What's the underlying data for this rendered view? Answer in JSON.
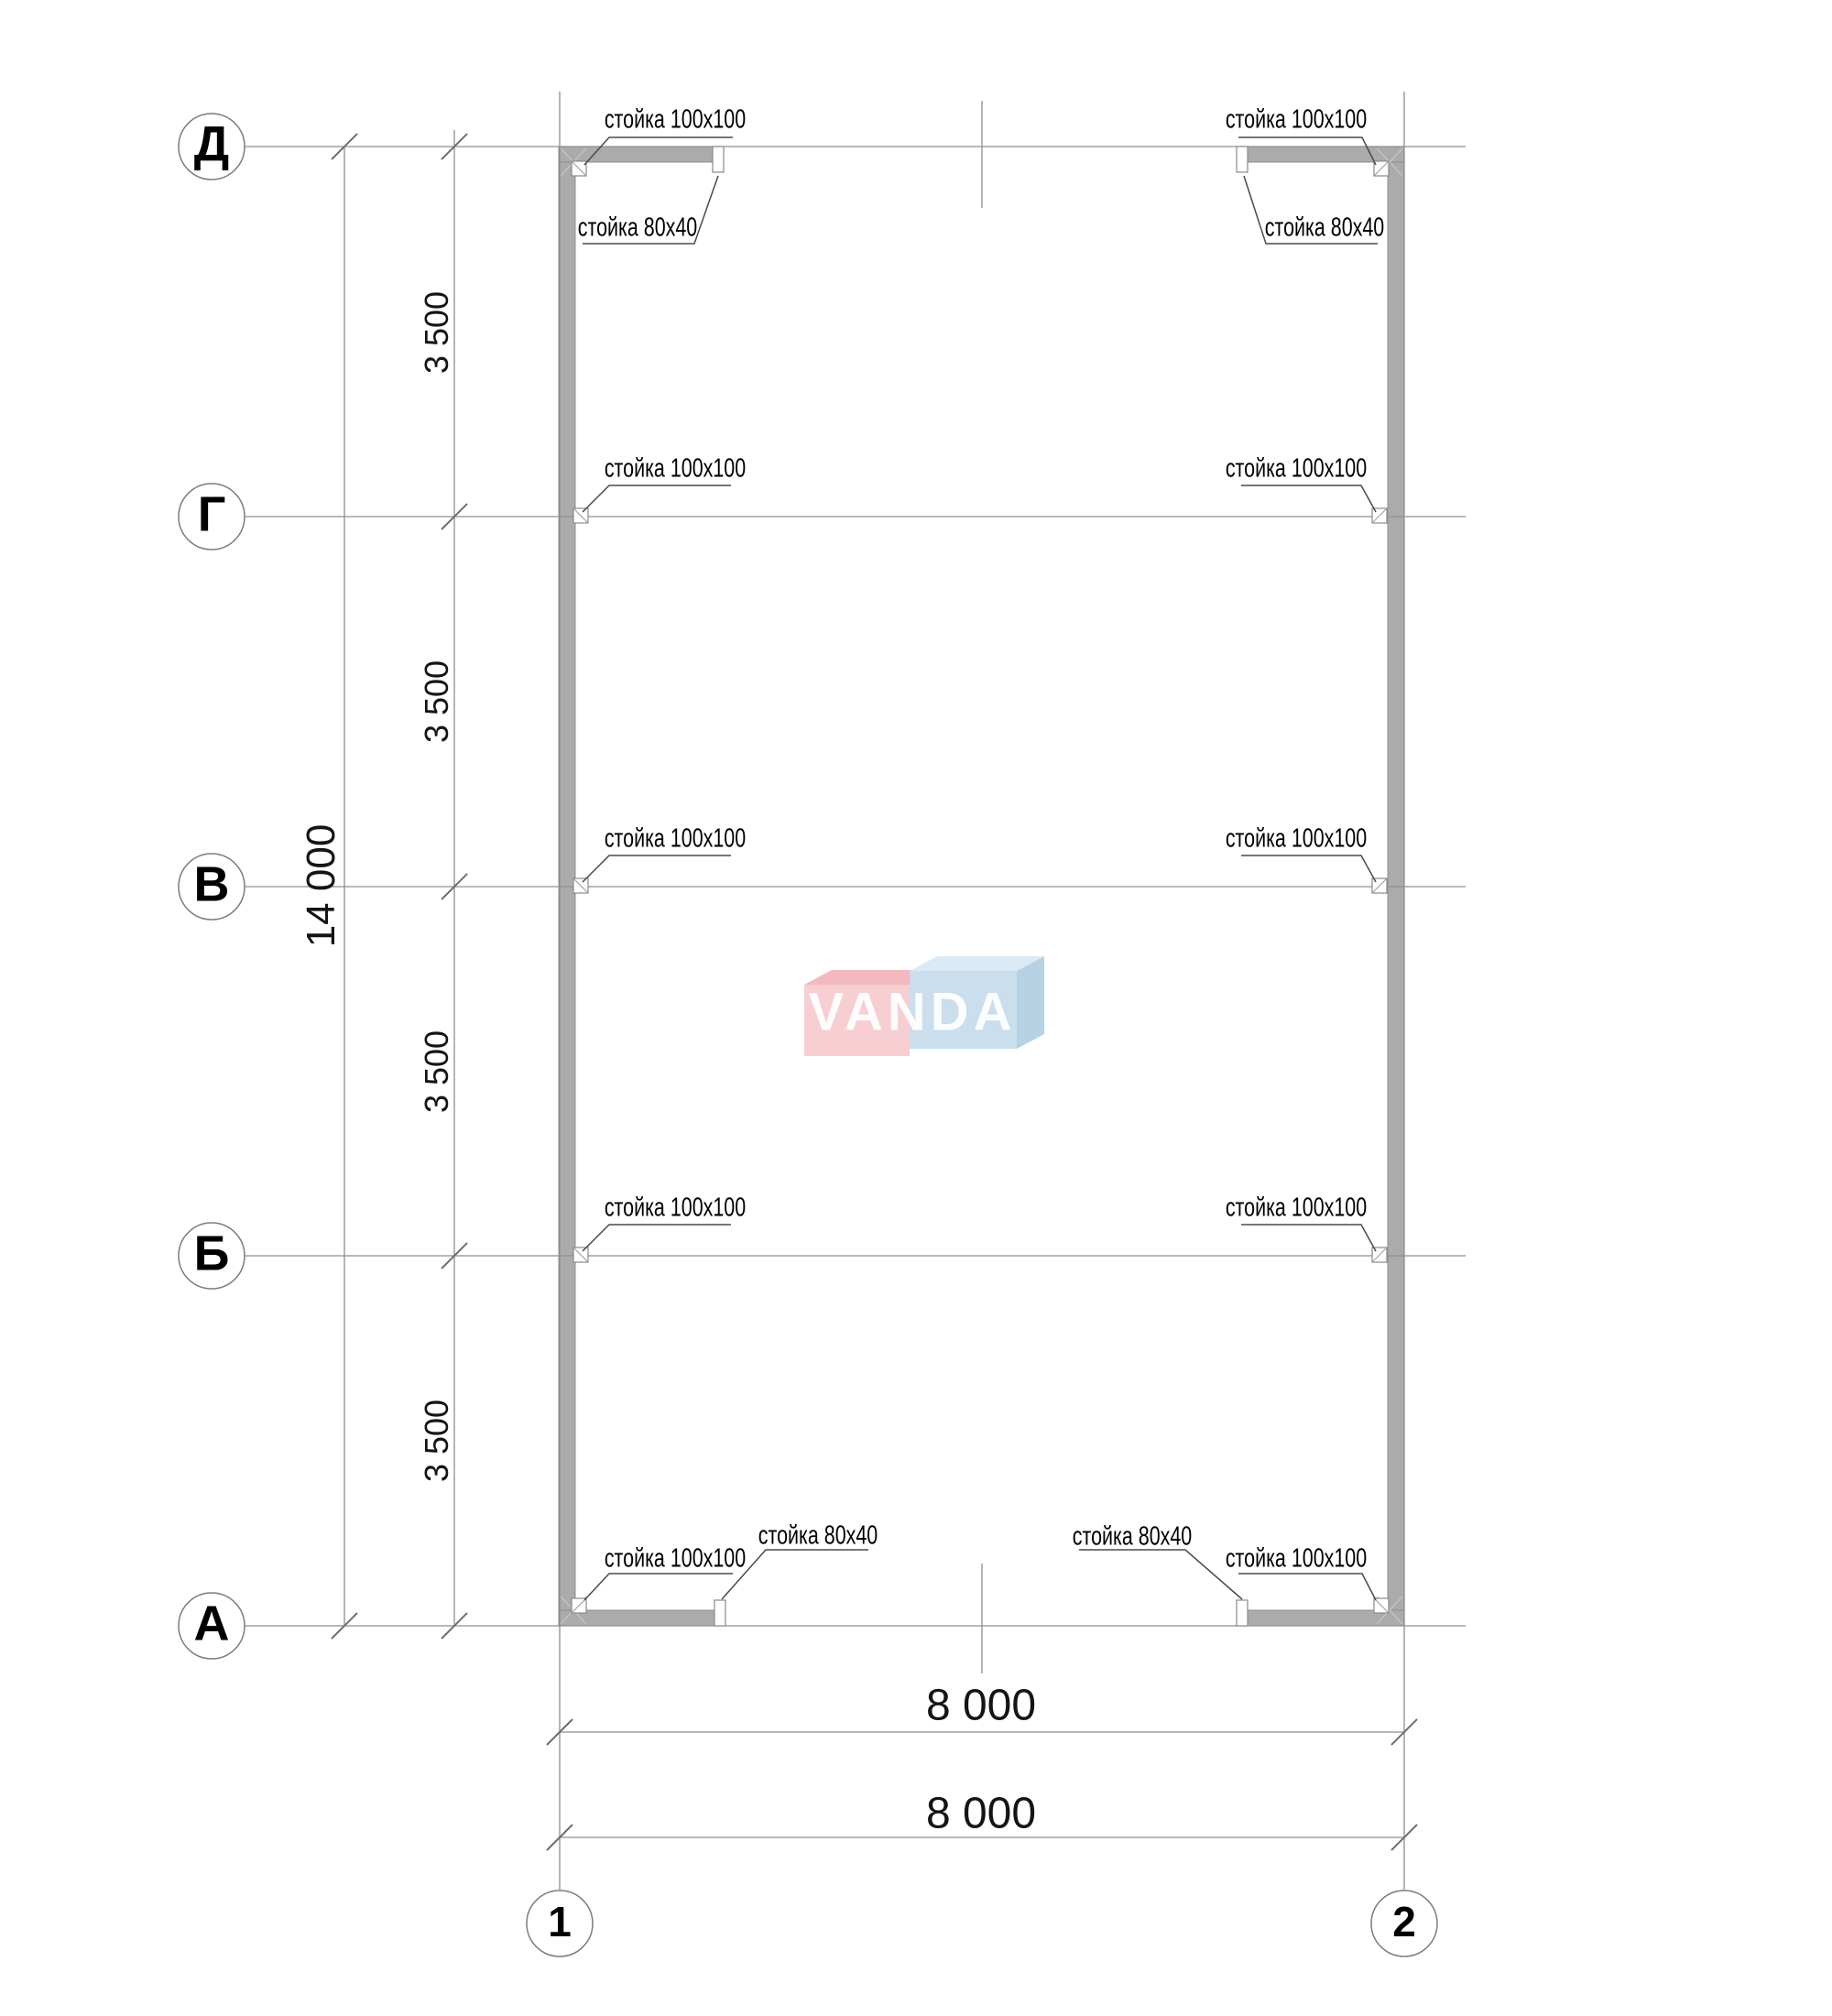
{
  "watermark": {
    "text": "VANDA"
  },
  "grid": {
    "rows": [
      {
        "label": "Д"
      },
      {
        "label": "Г"
      },
      {
        "label": "В"
      },
      {
        "label": "Б"
      },
      {
        "label": "А"
      }
    ],
    "cols": [
      {
        "label": "1"
      },
      {
        "label": "2"
      }
    ]
  },
  "dims": {
    "bays": [
      "3 500",
      "3 500",
      "3 500",
      "3 500"
    ],
    "total_height": "14 000",
    "width_top": "8 000",
    "width_bottom": "8 000"
  },
  "ann": {
    "post100": "стойка 100x100",
    "post80": "стойка 80x40"
  },
  "colors": {
    "wall": "#ababab",
    "wall_edge": "#8f8f8f",
    "grid_line": "#8f8f8f",
    "leader": "#4a4a4a",
    "watermark_pink": "#f7ced2",
    "watermark_pink_top": "#f3b9be",
    "watermark_blue": "#cadeed",
    "watermark_blue_top": "#daeaf6",
    "watermark_blue_side": "#b7d2e4",
    "watermark_text": "#ffffff"
  }
}
